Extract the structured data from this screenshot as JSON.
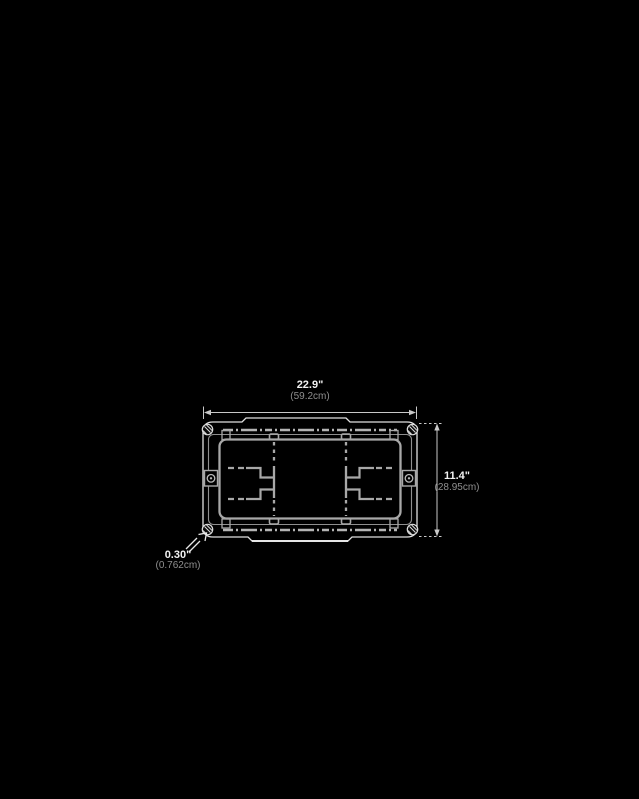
{
  "page": {
    "background_color": "#000000",
    "description": "Technical dimension diagram (top view of rectangular case)"
  },
  "diagram": {
    "colors": {
      "outline": "#e0e0e0",
      "detail_line": "#a8a8a8",
      "dimension_line": "#c8c8c8",
      "text_primary": "#f2f2f2",
      "text_secondary": "#8f8f8f"
    },
    "dimensions": {
      "width": {
        "inches": "22.9\"",
        "metric": "(59.2cm)"
      },
      "height": {
        "inches": "11.4\"",
        "metric": "(28.95cm)"
      },
      "foot": {
        "inches": "0.30\"",
        "metric": "(0.762cm)"
      }
    }
  }
}
